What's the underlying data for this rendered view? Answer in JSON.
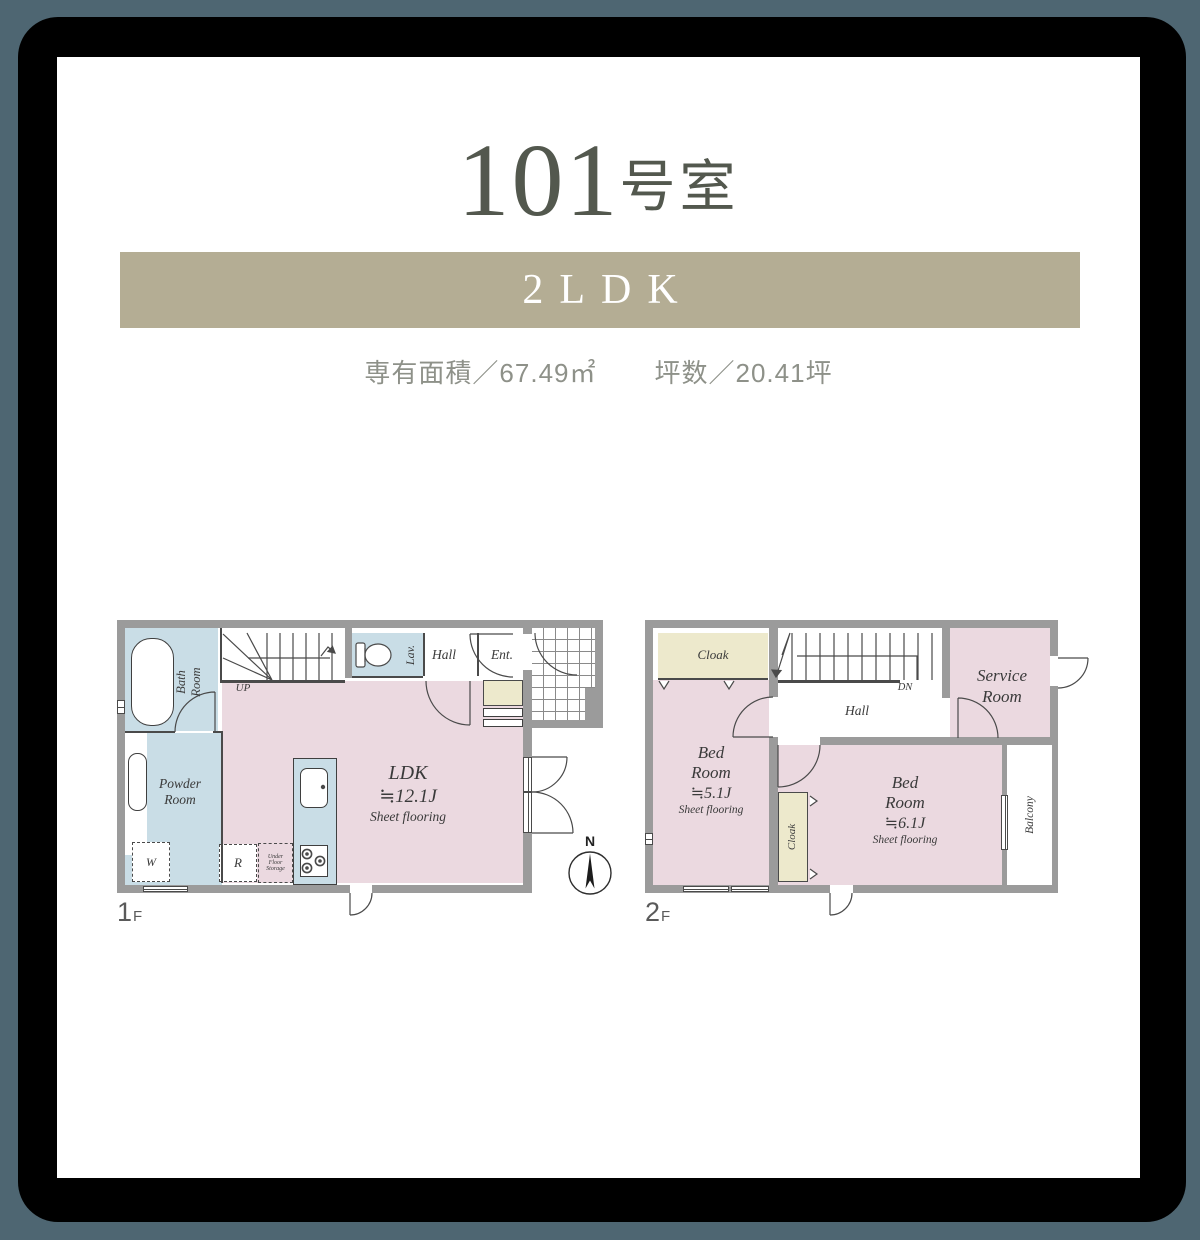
{
  "colors": {
    "slate": "#4e6672",
    "band": "#b4ad94",
    "title": "#53584e",
    "info": "#8e9189",
    "pink": "#ebd9e0",
    "blue": "#c9dde6",
    "cream": "#ede9cc",
    "wall": "#9b9b9b",
    "line": "#4a4a4a"
  },
  "header": {
    "room_number": "101",
    "room_suffix": "号室",
    "layout_type": "2LDK",
    "area_text": "専有面積／67.49㎡",
    "tsubo_text": "坪数／20.41坪"
  },
  "compass": {
    "north_label": "N"
  },
  "floor1": {
    "floor_number": "1",
    "floor_suffix": "F",
    "rooms": {
      "bath_line1": "Bath",
      "bath_line2": "Room",
      "up": "UP",
      "lav": "Lav.",
      "hall": "Hall",
      "ent": "Ent.",
      "powder_line1": "Powder",
      "powder_line2": "Room",
      "washer": "W",
      "fridge": "R",
      "ufs_line1": "Under",
      "ufs_line2": "Floor",
      "ufs_line3": "Storage",
      "ldk": "LDK",
      "ldk_size": "≒12.1J",
      "ldk_floor": "Sheet flooring"
    }
  },
  "floor2": {
    "floor_number": "2",
    "floor_suffix": "F",
    "rooms": {
      "cloak_top": "Cloak",
      "dn": "DN",
      "hall": "Hall",
      "service_line1": "Service",
      "service_line2": "Room",
      "bed1_line1": "Bed",
      "bed1_line2": "Room",
      "bed1_size": "≒5.1J",
      "bed1_floor": "Sheet flooring",
      "cloak_mid": "Cloak",
      "bed2_line1": "Bed",
      "bed2_line2": "Room",
      "bed2_size": "≒6.1J",
      "bed2_floor": "Sheet flooring",
      "balcony": "Balcony"
    }
  }
}
